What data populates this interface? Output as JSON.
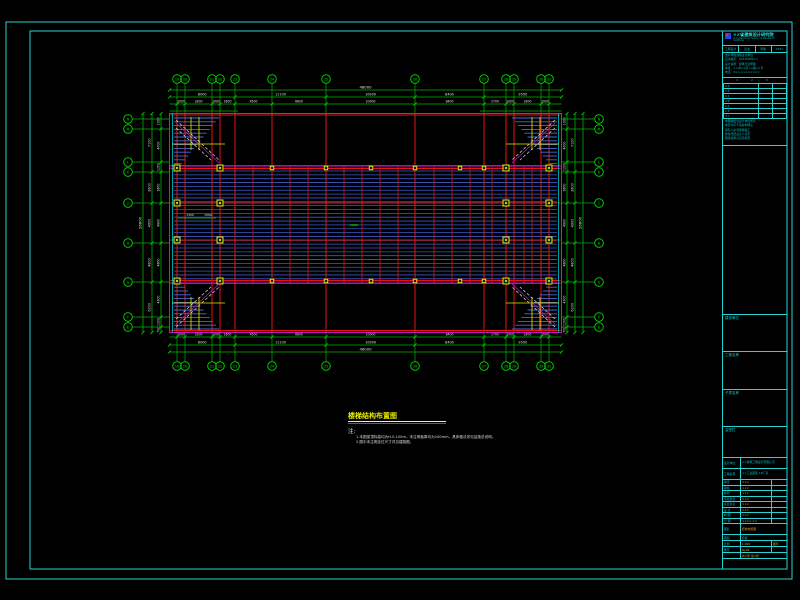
{
  "colors": {
    "bg": "#000000",
    "frame": "#27d3d3",
    "green": "#00b400",
    "green_bright": "#00e000",
    "red": "#cc1010",
    "red_bright": "#e81212",
    "blue": "#3b5bc8",
    "stair_blue": "#4a6ad0",
    "cyan": "#00c8c8",
    "magenta": "#c814c8",
    "yellow": "#e8e800",
    "white": "#e0e0e0",
    "orange": "#ff9a20"
  },
  "frame": {
    "outer": {
      "x": 6,
      "y": 22,
      "w": 786,
      "h": 557
    },
    "inner": {
      "x": 30,
      "y": 31,
      "w": 757,
      "h": 538
    }
  },
  "plan": {
    "outline": {
      "x": 169.5,
      "y": 113.5,
      "w": 392,
      "h": 219
    },
    "cyan_edges_x": [
      172.5,
      558.5
    ],
    "majors_x": [
      177,
      185,
      212,
      220,
      235,
      272,
      326,
      415,
      484,
      506,
      514,
      541,
      549
    ],
    "secondary_x": [
      253,
      290,
      308,
      344,
      362,
      380,
      398,
      434,
      452,
      470,
      492,
      524,
      532
    ],
    "beams_y": [
      115,
      165.5,
      168.5,
      203,
      240,
      280.5,
      283.5,
      330.5
    ],
    "joists": {
      "y1": 171,
      "y2": 279,
      "step": 3.85,
      "x1": 174,
      "x2": 557
    },
    "columns_big": {
      "xs": [
        177,
        220,
        506,
        549
      ],
      "ys": [
        168,
        203,
        240,
        281
      ]
    },
    "columns_small": {
      "xs": [
        272,
        326,
        371,
        415,
        460,
        484
      ],
      "ys": [
        168,
        281
      ]
    },
    "stairs": [
      {
        "c": "tl",
        "x": 174,
        "y": 116
      },
      {
        "c": "tr",
        "x": 508,
        "y": 116
      },
      {
        "c": "bl",
        "x": 174,
        "y": 281
      },
      {
        "c": "br",
        "x": 508,
        "y": 281
      }
    ],
    "stair_size": {
      "w": 49,
      "h": 50
    },
    "inner_marks": {
      "center_dash": {
        "x1": 350,
        "y1": 225,
        "x2": 358,
        "y2": 225
      },
      "small_dim": {
        "x1": 178,
        "y1": 218,
        "x2": 216,
        "y2": 218,
        "labels": [
          {
            "x": 190,
            "y": 216,
            "t": "1350"
          },
          {
            "x": 208,
            "y": 216,
            "t": "1500"
          }
        ]
      }
    },
    "bubbles": {
      "top": {
        "y": 79,
        "labels": [
          "19",
          "20",
          "21",
          "22",
          "23",
          "24",
          "25",
          "26",
          "27",
          "28",
          "29",
          "30",
          "31"
        ]
      },
      "bottom": {
        "y": 366,
        "labels": [
          "19",
          "20",
          "21",
          "22",
          "23",
          "24",
          "25",
          "26",
          "27",
          "28",
          "29",
          "30",
          "31"
        ]
      },
      "left": {
        "x": 128,
        "ys": [
          119,
          129,
          162,
          172,
          203,
          243,
          282,
          317,
          327
        ],
        "labels": [
          "N",
          "M",
          "L",
          "K",
          "J",
          "H",
          "G",
          "F",
          "E"
        ]
      },
      "right": {
        "x": 599,
        "ys": [
          119,
          129,
          162,
          172,
          203,
          243,
          282,
          317,
          327
        ],
        "labels": [
          "N",
          "M",
          "L",
          "K",
          "J",
          "H",
          "G",
          "F",
          "E"
        ]
      }
    },
    "dims": {
      "top": {
        "lines_y": [
          90,
          97,
          104
        ],
        "stub_y": 111,
        "overall": "48000",
        "segs": {
          "bounds": [
            169.5,
            235,
            326,
            415,
            484,
            561.5
          ],
          "labels": [
            "8000",
            "11100",
            "10900",
            "8400",
            "9500"
          ]
        },
        "fine": {
          "labels": [
            "1000",
            "3300",
            "1000",
            "1800",
            "4500",
            "6600",
            "10900",
            "8400",
            "2700",
            "1000",
            "3300",
            "1000"
          ]
        }
      },
      "bottom": {
        "lines_y": [
          352,
          345,
          337
        ],
        "overall": "48000",
        "segs": {
          "bounds": [
            169.5,
            235,
            326,
            415,
            484,
            561.5
          ],
          "labels": [
            "8000",
            "11100",
            "10900",
            "8400",
            "9500"
          ]
        },
        "fine": {
          "labels": [
            "1000",
            "3300",
            "1000",
            "1800",
            "4500",
            "6600",
            "10900",
            "8400",
            "2700",
            "1000",
            "3300",
            "1000"
          ]
        }
      },
      "left": {
        "lines_x": [
          143,
          152,
          161
        ],
        "overall": "26800",
        "segs": {
          "bounds": [
            113.5,
            172,
            203,
            243,
            282,
            332.5
          ],
          "labels": [
            "7100",
            "3800",
            "4900",
            "4800",
            "6200"
          ]
        },
        "fine": {
          "bounds": [
            113.5,
            129,
            162,
            172,
            203,
            243,
            282,
            317,
            327,
            332.5
          ],
          "labels": [
            "1900",
            "4000",
            "1200",
            "3800",
            "4900",
            "4800",
            "4300",
            "1200",
            "700"
          ]
        }
      },
      "right": {
        "lines_x": [
          583,
          575,
          567
        ],
        "overall": "26800",
        "segs": {
          "bounds": [
            113.5,
            172,
            203,
            243,
            282,
            332.5
          ],
          "labels": [
            "7100",
            "3800",
            "4900",
            "4800",
            "6200"
          ]
        },
        "fine": {
          "bounds": [
            113.5,
            129,
            162,
            172,
            203,
            243,
            282,
            317,
            327,
            332.5
          ],
          "labels": [
            "1900",
            "4000",
            "1200",
            "3800",
            "4900",
            "4800",
            "4300",
            "1200",
            "700"
          ]
        }
      }
    }
  },
  "notes": {
    "title": "楼梯结构布置图",
    "note_label": "注:",
    "items": [
      "1.本图梁顶标高均为H-0.100m，未注明板厚均为100mm，具体做法详见结施总说明。",
      "2.图中未注明定位尺寸详见建施图。"
    ]
  },
  "titleblock": {
    "company": "××省建筑设计研究院",
    "company_sub": "Architectural Design & Research Institute",
    "cert_cells": [
      "工程设计",
      "证书",
      "甲级",
      "A151"
    ],
    "info_lines": [
      "国家甲级勘察设计单位",
      "证书编号：A1510000××",
      "设计资质：建筑行业甲级",
      "地址：××市××区××路××号",
      "电话：0××-××××××××"
    ],
    "rev_header": "1  2  3",
    "rev_col1": [
      "4 6",
      "1 4",
      "9 4",
      "2 6",
      "4 4",
      "1 4",
      "4 7",
      "2 1"
    ],
    "note_lines": [
      "本图版权归设计单位所有",
      "未经许可不得复制转让",
      "承包人必须按图施工",
      "修改须经设计人签字",
      "图纸会审记录见附页"
    ],
    "sec_labels": [
      "建设单位",
      "工程名称",
      "子项名称",
      "会签栏"
    ],
    "bt": {
      "r1_label": "设计单位",
      "r1_value": "××建筑工程设计有限公司",
      "r2_label": "工程名称",
      "r2_value": "××工业园区 1#厂房",
      "sign_rows": [
        [
          "审定",
          "×××"
        ],
        [
          "审核",
          "×××"
        ],
        [
          "校对",
          "×××"
        ],
        [
          "专业负责",
          "×××"
        ],
        [
          "项目负责",
          "×××"
        ],
        [
          "设 计",
          "×××"
        ],
        [
          "制 图",
          "×××"
        ],
        [
          "日 期",
          "××××.××"
        ]
      ],
      "drawing_name_label": "图名",
      "drawing_name": "结构布置图",
      "type_label": "图别",
      "type_value": "结施",
      "scale_label": "比例",
      "scale_value": "1:100",
      "no_label": "图号",
      "no_value": "GJ-02",
      "footer": "共×张 第×张"
    }
  }
}
